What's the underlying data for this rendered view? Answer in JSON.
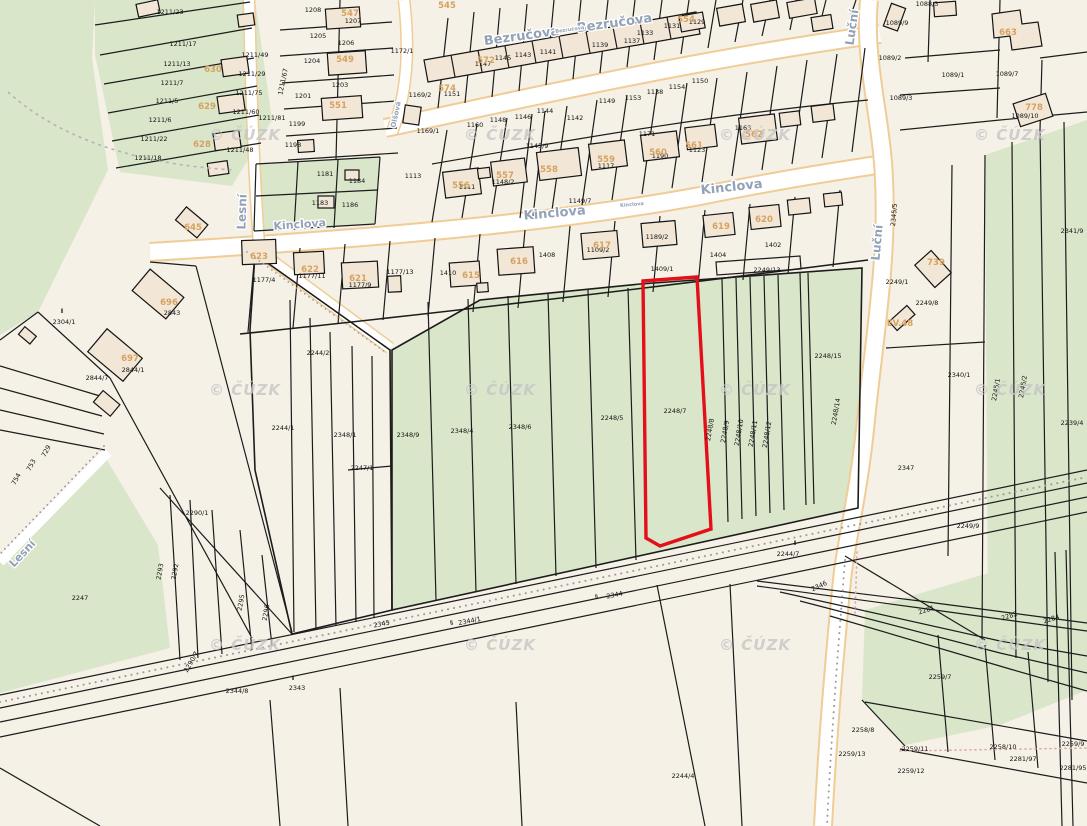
{
  "map": {
    "attribution": "© ČÚZK",
    "colors": {
      "background": "#f5f1e7",
      "field_green": "#d9e6ca",
      "road_white": "#ffffff",
      "road_edge_orange": "#f0cc96",
      "building_fill": "#f2e7d6",
      "parcel_line": "#1c1c1c",
      "street_label": "#93a2b6",
      "building_label": "#d7a15f",
      "highlight_red": "#e3101a",
      "watermark_gray": "#c6c6c6"
    },
    "highlight": {
      "parcel_number": "2248/7",
      "outline_color": "#e3101a"
    },
    "streets": [
      {
        "t": "Bezručova",
        "x": 522,
        "y": 40,
        "r": -8,
        "s": 13
      },
      {
        "t": "Bezručova",
        "x": 615,
        "y": 27,
        "r": -8,
        "s": 13
      },
      {
        "t": "Bezručova",
        "x": 570,
        "y": 31,
        "r": -8,
        "s": 5
      },
      {
        "t": "Kinclova",
        "x": 300,
        "y": 228,
        "r": -4,
        "s": 11
      },
      {
        "t": "Kinclova",
        "x": 555,
        "y": 217,
        "r": -5,
        "s": 13
      },
      {
        "t": "Kinclova",
        "x": 632,
        "y": 206,
        "r": -5,
        "s": 5
      },
      {
        "t": "Kinclova",
        "x": 732,
        "y": 191,
        "r": -6,
        "s": 13
      },
      {
        "t": "Lesní",
        "x": 246,
        "y": 212,
        "r": -88,
        "s": 12
      },
      {
        "t": "Lesní",
        "x": 25,
        "y": 556,
        "r": -47,
        "s": 11
      },
      {
        "t": "Luční",
        "x": 856,
        "y": 28,
        "r": -82,
        "s": 12
      },
      {
        "t": "Luční",
        "x": 881,
        "y": 243,
        "r": -85,
        "s": 12
      },
      {
        "t": "Olšová",
        "x": 398,
        "y": 115,
        "r": -78,
        "s": 7
      }
    ],
    "watermark": {
      "text": "© ČÚZK",
      "positions": [
        [
          245,
          140
        ],
        [
          500,
          140
        ],
        [
          755,
          140
        ],
        [
          1010,
          140
        ],
        [
          245,
          395
        ],
        [
          500,
          395
        ],
        [
          755,
          395
        ],
        [
          1010,
          395
        ],
        [
          245,
          650
        ],
        [
          500,
          650
        ],
        [
          755,
          650
        ],
        [
          1010,
          650
        ]
      ]
    },
    "building_labels": [
      {
        "t": "545",
        "x": 447,
        "y": 8
      },
      {
        "t": "547",
        "x": 350,
        "y": 16
      },
      {
        "t": "549",
        "x": 345,
        "y": 62
      },
      {
        "t": "551",
        "x": 338,
        "y": 108
      },
      {
        "t": "554",
        "x": 686,
        "y": 22
      },
      {
        "t": "556",
        "x": 461,
        "y": 188
      },
      {
        "t": "557",
        "x": 505,
        "y": 178
      },
      {
        "t": "558",
        "x": 549,
        "y": 172
      },
      {
        "t": "559",
        "x": 606,
        "y": 162
      },
      {
        "t": "560",
        "x": 658,
        "y": 155
      },
      {
        "t": "561",
        "x": 694,
        "y": 148
      },
      {
        "t": "562",
        "x": 754,
        "y": 137
      },
      {
        "t": "572",
        "x": 486,
        "y": 63
      },
      {
        "t": "574",
        "x": 447,
        "y": 91
      },
      {
        "t": "615",
        "x": 471,
        "y": 278
      },
      {
        "t": "616",
        "x": 519,
        "y": 264
      },
      {
        "t": "617",
        "x": 602,
        "y": 248
      },
      {
        "t": "619",
        "x": 721,
        "y": 229
      },
      {
        "t": "620",
        "x": 764,
        "y": 222
      },
      {
        "t": "621",
        "x": 358,
        "y": 281
      },
      {
        "t": "622",
        "x": 310,
        "y": 272
      },
      {
        "t": "623",
        "x": 259,
        "y": 259
      },
      {
        "t": "628",
        "x": 202,
        "y": 147
      },
      {
        "t": "629",
        "x": 207,
        "y": 109
      },
      {
        "t": "630",
        "x": 213,
        "y": 72
      },
      {
        "t": "645",
        "x": 193,
        "y": 230
      },
      {
        "t": "663",
        "x": 1008,
        "y": 35
      },
      {
        "t": "696",
        "x": 169,
        "y": 305
      },
      {
        "t": "697",
        "x": 130,
        "y": 361
      },
      {
        "t": "739",
        "x": 936,
        "y": 265
      },
      {
        "t": "778",
        "x": 1034,
        "y": 110
      },
      {
        "t": "EV.48",
        "x": 900,
        "y": 326
      }
    ],
    "parcel_labels": [
      {
        "t": "1211/23",
        "x": 170,
        "y": 14
      },
      {
        "t": "1211/17",
        "x": 183,
        "y": 46
      },
      {
        "t": "1211/13",
        "x": 177,
        "y": 66
      },
      {
        "t": "1211/7",
        "x": 172,
        "y": 85
      },
      {
        "t": "1211/5",
        "x": 167,
        "y": 103
      },
      {
        "t": "1211/6",
        "x": 160,
        "y": 122
      },
      {
        "t": "1211/22",
        "x": 154,
        "y": 141
      },
      {
        "t": "1211/18",
        "x": 148,
        "y": 160
      },
      {
        "t": "1211/49",
        "x": 255,
        "y": 57
      },
      {
        "t": "1211/29",
        "x": 252,
        "y": 76
      },
      {
        "t": "1211/75",
        "x": 249,
        "y": 95
      },
      {
        "t": "1211/60",
        "x": 246,
        "y": 114
      },
      {
        "t": "1211/48",
        "x": 240,
        "y": 152
      },
      {
        "t": "1211/81",
        "x": 272,
        "y": 120
      },
      {
        "t": "1211/67",
        "x": 285,
        "y": 82,
        "r": -78
      },
      {
        "t": "1208",
        "x": 313,
        "y": 12
      },
      {
        "t": "1205",
        "x": 318,
        "y": 38
      },
      {
        "t": "1204",
        "x": 312,
        "y": 63
      },
      {
        "t": "1201",
        "x": 303,
        "y": 98
      },
      {
        "t": "1199",
        "x": 297,
        "y": 126
      },
      {
        "t": "1198",
        "x": 293,
        "y": 147
      },
      {
        "t": "1207",
        "x": 353,
        "y": 23
      },
      {
        "t": "1206",
        "x": 346,
        "y": 45
      },
      {
        "t": "1203",
        "x": 340,
        "y": 87
      },
      {
        "t": "1172/1",
        "x": 402,
        "y": 53
      },
      {
        "t": "1169/2",
        "x": 420,
        "y": 97
      },
      {
        "t": "1169/1",
        "x": 428,
        "y": 133
      },
      {
        "t": "1181",
        "x": 325,
        "y": 176
      },
      {
        "t": "1184",
        "x": 357,
        "y": 183
      },
      {
        "t": "1183",
        "x": 320,
        "y": 205
      },
      {
        "t": "1186",
        "x": 350,
        "y": 207
      },
      {
        "t": "1147",
        "x": 483,
        "y": 66
      },
      {
        "t": "1145",
        "x": 503,
        "y": 60
      },
      {
        "t": "1143",
        "x": 523,
        "y": 57
      },
      {
        "t": "1141",
        "x": 548,
        "y": 54
      },
      {
        "t": "1139",
        "x": 600,
        "y": 47
      },
      {
        "t": "1137",
        "x": 632,
        "y": 43
      },
      {
        "t": "1133",
        "x": 645,
        "y": 35
      },
      {
        "t": "1131",
        "x": 672,
        "y": 28
      },
      {
        "t": "1129",
        "x": 697,
        "y": 24
      },
      {
        "t": "1151",
        "x": 452,
        "y": 96
      },
      {
        "t": "1160",
        "x": 475,
        "y": 127
      },
      {
        "t": "1148",
        "x": 498,
        "y": 122
      },
      {
        "t": "1146",
        "x": 523,
        "y": 119
      },
      {
        "t": "1144",
        "x": 545,
        "y": 113
      },
      {
        "t": "1142",
        "x": 575,
        "y": 120
      },
      {
        "t": "1149",
        "x": 607,
        "y": 103
      },
      {
        "t": "1153",
        "x": 633,
        "y": 100
      },
      {
        "t": "1138",
        "x": 655,
        "y": 94
      },
      {
        "t": "1154",
        "x": 677,
        "y": 89
      },
      {
        "t": "1150",
        "x": 700,
        "y": 83
      },
      {
        "t": "1113",
        "x": 413,
        "y": 178
      },
      {
        "t": "1111",
        "x": 467,
        "y": 189
      },
      {
        "t": "1148/2",
        "x": 503,
        "y": 184
      },
      {
        "t": "1149/7",
        "x": 580,
        "y": 203
      },
      {
        "t": "1145/9",
        "x": 537,
        "y": 148
      },
      {
        "t": "1117",
        "x": 606,
        "y": 168
      },
      {
        "t": "1171",
        "x": 647,
        "y": 136
      },
      {
        "t": "1190",
        "x": 660,
        "y": 158
      },
      {
        "t": "1123",
        "x": 697,
        "y": 152
      },
      {
        "t": "1163",
        "x": 743,
        "y": 130
      },
      {
        "t": "1177/4",
        "x": 264,
        "y": 282
      },
      {
        "t": "1177/11",
        "x": 312,
        "y": 278
      },
      {
        "t": "1177/9",
        "x": 360,
        "y": 287
      },
      {
        "t": "1177/13",
        "x": 400,
        "y": 274
      },
      {
        "t": "1410",
        "x": 448,
        "y": 275
      },
      {
        "t": "1408",
        "x": 547,
        "y": 257
      },
      {
        "t": "1109/2",
        "x": 598,
        "y": 252
      },
      {
        "t": "1189/2",
        "x": 657,
        "y": 239
      },
      {
        "t": "1409/1",
        "x": 662,
        "y": 271
      },
      {
        "t": "1404",
        "x": 718,
        "y": 257
      },
      {
        "t": "1402",
        "x": 773,
        "y": 247
      },
      {
        "t": "2249/13",
        "x": 767,
        "y": 272
      },
      {
        "t": "Ⅱ",
        "x": 62,
        "y": 313
      },
      {
        "t": "2304/1",
        "x": 64,
        "y": 324
      },
      {
        "t": "2843",
        "x": 172,
        "y": 315
      },
      {
        "t": "2844/1",
        "x": 133,
        "y": 372
      },
      {
        "t": "2844/7",
        "x": 97,
        "y": 380
      },
      {
        "t": "729",
        "x": 48,
        "y": 452,
        "r": -62
      },
      {
        "t": "753",
        "x": 33,
        "y": 466,
        "r": -62
      },
      {
        "t": "754",
        "x": 18,
        "y": 480,
        "r": -62
      },
      {
        "t": "2247",
        "x": 80,
        "y": 600
      },
      {
        "t": "2244/1",
        "x": 283,
        "y": 430
      },
      {
        "t": "2244/2",
        "x": 318,
        "y": 355
      },
      {
        "t": "2247/1",
        "x": 362,
        "y": 470
      },
      {
        "t": "2348/1",
        "x": 345,
        "y": 437
      },
      {
        "t": "2348/9",
        "x": 408,
        "y": 437
      },
      {
        "t": "2348/4",
        "x": 462,
        "y": 433
      },
      {
        "t": "2348/6",
        "x": 520,
        "y": 429
      },
      {
        "t": "2248/5",
        "x": 612,
        "y": 420
      },
      {
        "t": "2248/7",
        "x": 675,
        "y": 413
      },
      {
        "t": "2248/15",
        "x": 828,
        "y": 358
      },
      {
        "t": "2248/8",
        "x": 712,
        "y": 430,
        "r": -80
      },
      {
        "t": "2248/9",
        "x": 727,
        "y": 432,
        "r": -80
      },
      {
        "t": "2248/10",
        "x": 741,
        "y": 433,
        "r": -80
      },
      {
        "t": "2248/11",
        "x": 755,
        "y": 434,
        "r": -80
      },
      {
        "t": "2248/12",
        "x": 769,
        "y": 435,
        "r": -80
      },
      {
        "t": "2248/14",
        "x": 838,
        "y": 412,
        "r": -80
      },
      {
        "t": "2345",
        "x": 382,
        "y": 626,
        "r": -11
      },
      {
        "t": "Ⅱ",
        "x": 452,
        "y": 625,
        "r": -11
      },
      {
        "t": "2344/1",
        "x": 470,
        "y": 623,
        "r": -11
      },
      {
        "t": "Ⅱ",
        "x": 597,
        "y": 599,
        "r": -11
      },
      {
        "t": "2344",
        "x": 615,
        "y": 597,
        "r": -11
      },
      {
        "t": "2346",
        "x": 820,
        "y": 588,
        "r": -25
      },
      {
        "t": "Ⅱ",
        "x": 795,
        "y": 545
      },
      {
        "t": "2244/7",
        "x": 788,
        "y": 556
      },
      {
        "t": "2244/4",
        "x": 683,
        "y": 778
      },
      {
        "t": "Ⅱ",
        "x": 293,
        "y": 680
      },
      {
        "t": "2343",
        "x": 297,
        "y": 690
      },
      {
        "t": "2344/8",
        "x": 237,
        "y": 693
      },
      {
        "t": "2290/1",
        "x": 197,
        "y": 515
      },
      {
        "t": "2292",
        "x": 177,
        "y": 572,
        "r": -80
      },
      {
        "t": "2293",
        "x": 162,
        "y": 572,
        "r": -80
      },
      {
        "t": "2295",
        "x": 243,
        "y": 603,
        "r": -80
      },
      {
        "t": "2296",
        "x": 268,
        "y": 613,
        "r": -80
      },
      {
        "t": "2290/7",
        "x": 193,
        "y": 663,
        "r": -60
      },
      {
        "t": "1089/9",
        "x": 897,
        "y": 25
      },
      {
        "t": "1088/3",
        "x": 927,
        "y": 6
      },
      {
        "t": "1089/2",
        "x": 890,
        "y": 60
      },
      {
        "t": "1089/1",
        "x": 953,
        "y": 77
      },
      {
        "t": "1089/7",
        "x": 1007,
        "y": 76
      },
      {
        "t": "1089/3",
        "x": 901,
        "y": 100
      },
      {
        "t": "1089/10",
        "x": 1025,
        "y": 118
      },
      {
        "t": "2341/9",
        "x": 1072,
        "y": 233
      },
      {
        "t": "2249/1",
        "x": 897,
        "y": 284
      },
      {
        "t": "2249/8",
        "x": 927,
        "y": 305
      },
      {
        "t": "2340/1",
        "x": 959,
        "y": 377
      },
      {
        "t": "2245/1",
        "x": 998,
        "y": 390,
        "r": -80
      },
      {
        "t": "2245/2",
        "x": 1025,
        "y": 387,
        "r": -80
      },
      {
        "t": "2239/4",
        "x": 1072,
        "y": 425
      },
      {
        "t": "2347",
        "x": 906,
        "y": 470
      },
      {
        "t": "2249/9",
        "x": 968,
        "y": 528
      },
      {
        "t": "2345/5",
        "x": 896,
        "y": 215,
        "r": -85
      },
      {
        "t": "2281",
        "x": 927,
        "y": 612,
        "r": -18
      },
      {
        "t": "2282",
        "x": 1010,
        "y": 618,
        "r": -18
      },
      {
        "t": "2284",
        "x": 1052,
        "y": 621,
        "r": -18
      },
      {
        "t": "2259/7",
        "x": 940,
        "y": 679
      },
      {
        "t": "2258/8",
        "x": 863,
        "y": 732
      },
      {
        "t": "2259/13",
        "x": 852,
        "y": 756
      },
      {
        "t": "2259/11",
        "x": 915,
        "y": 751
      },
      {
        "t": "2259/12",
        "x": 911,
        "y": 773
      },
      {
        "t": "2258/10",
        "x": 1003,
        "y": 749
      },
      {
        "t": "2259/9",
        "x": 1073,
        "y": 746
      },
      {
        "t": "2281/97",
        "x": 1023,
        "y": 761
      },
      {
        "t": "2281/95",
        "x": 1073,
        "y": 770
      }
    ]
  }
}
